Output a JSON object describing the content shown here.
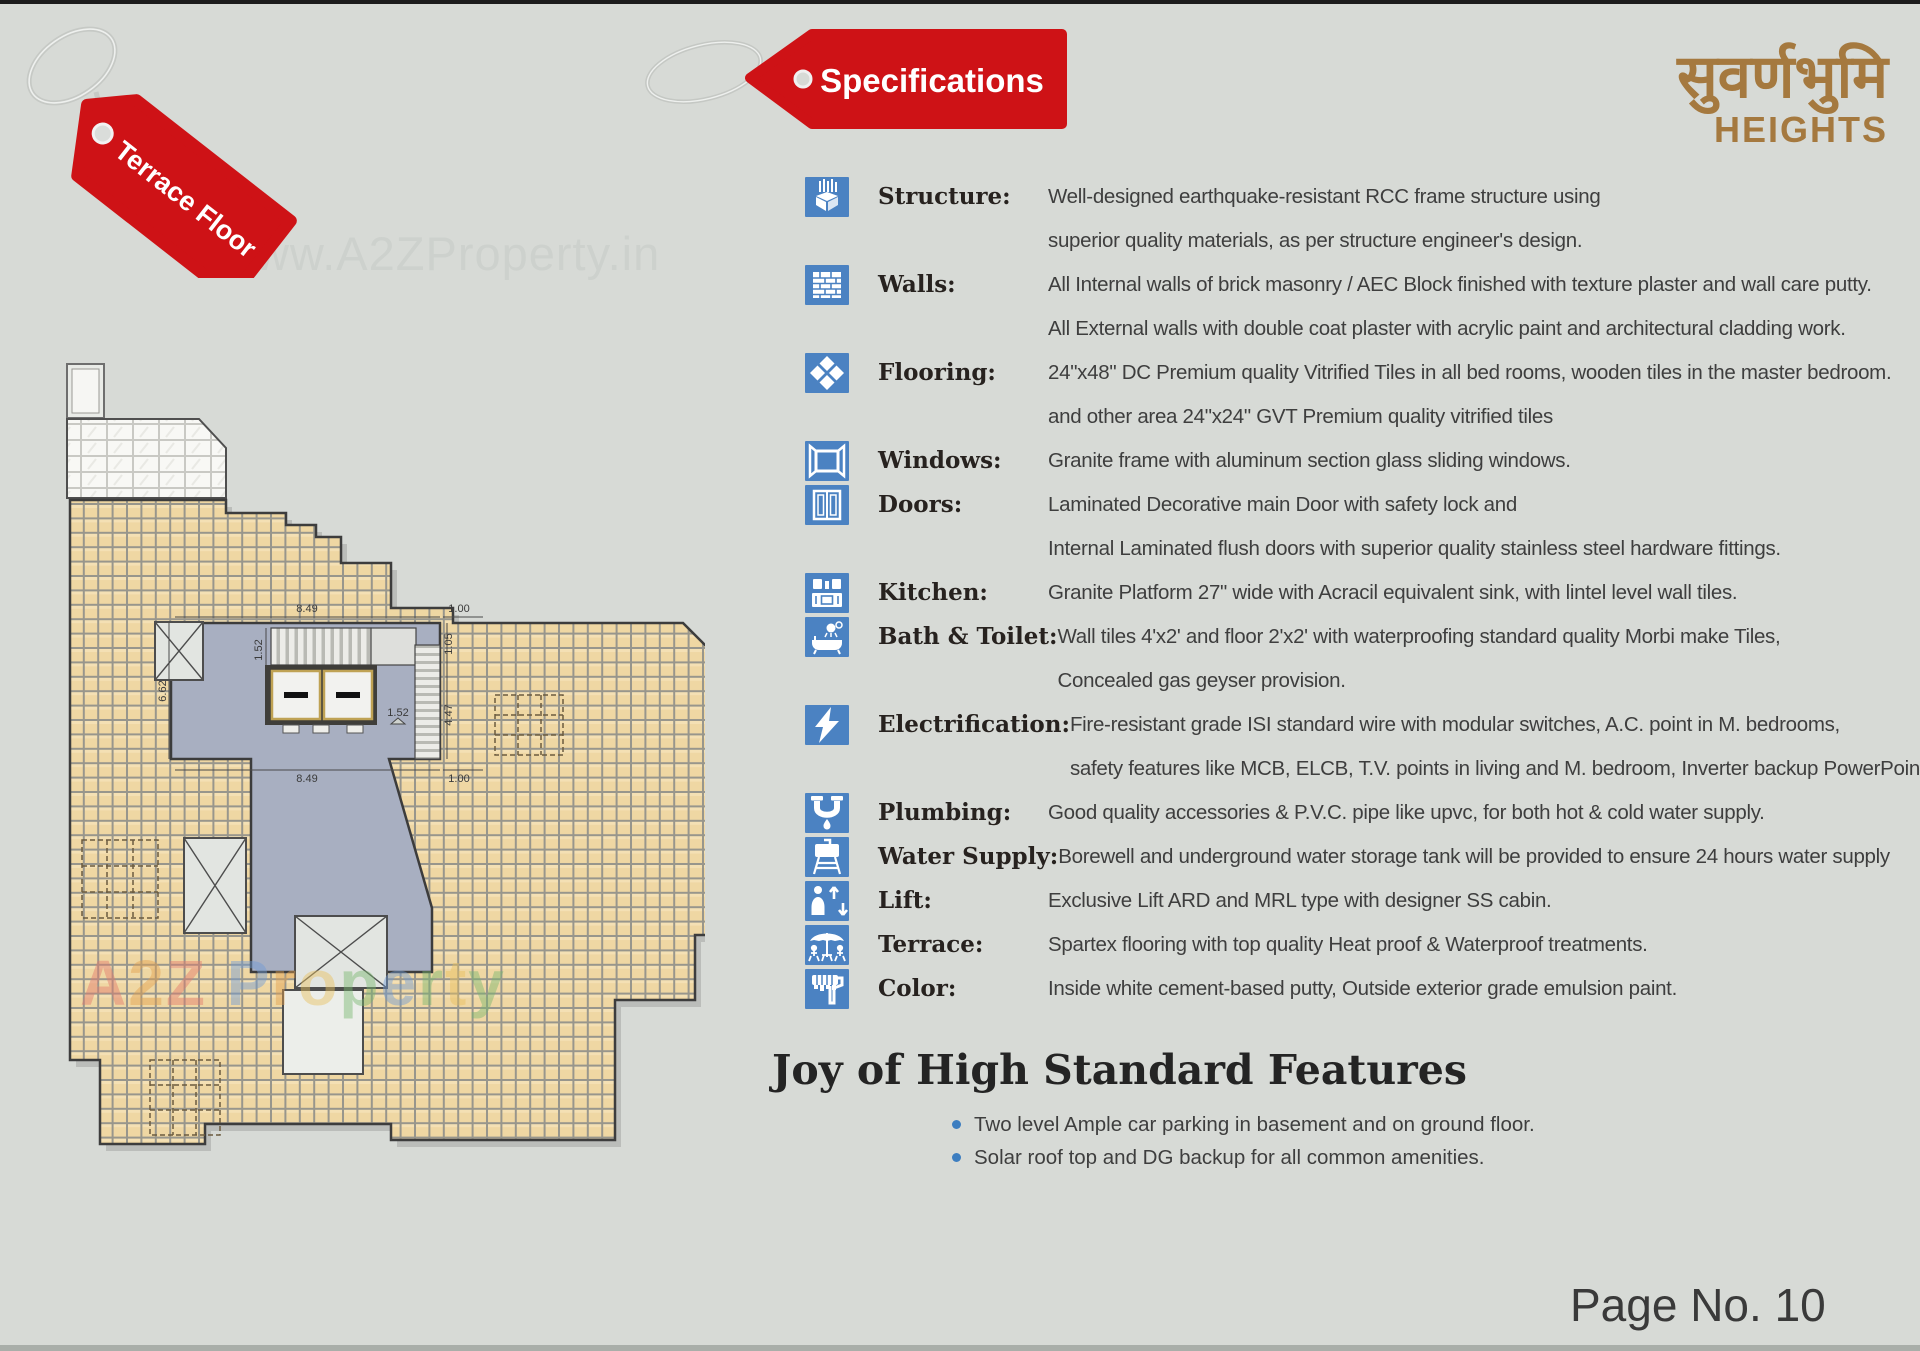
{
  "page": {
    "background": "#d7dad6",
    "page_no": "Page No. 10"
  },
  "tags": {
    "floor_tag": "Terrace Floor",
    "spec_tag": "Specifications",
    "tag_color": "#ce1216"
  },
  "brand": {
    "name_devanagari": "सुवर्णभुमि",
    "name_sub": "HEIGHTS",
    "color": "#a5793f"
  },
  "watermarks": {
    "top": "www.A2ZProperty.in",
    "middle": "A2Z Property",
    "middle_colors": [
      "#e27a6c",
      "#e2a04e",
      "#e27a6c",
      "#000000",
      "#6f9bd6",
      "#e2a04e",
      "#e9c05e",
      "#79b76f",
      "#6f9bd6",
      "#79b76f",
      "#e9c05e",
      "#79b76f"
    ]
  },
  "specs": {
    "icon_color": "#4b82c2",
    "rows": [
      {
        "icon": "structure-icon",
        "label": "Structure:",
        "lines": [
          "Well-designed earthquake-resistant RCC frame structure using",
          "superior quality materials, as per structure engineer's design."
        ]
      },
      {
        "icon": "walls-icon",
        "label": "Walls:",
        "lines": [
          "All Internal walls of brick masonry / AEC Block finished with texture plaster and wall care putty.",
          "All External walls with double coat plaster with acrylic paint and architectural cladding work."
        ]
      },
      {
        "icon": "flooring-icon",
        "label": "Flooring:",
        "lines": [
          "24\"x48\" DC Premium quality Vitrified Tiles in all bed rooms, wooden tiles in the master bedroom.",
          "and other area 24\"x24\" GVT Premium quality vitrified tiles"
        ]
      },
      {
        "icon": "windows-icon",
        "label": "Windows:",
        "lines": [
          "Granite frame with aluminum section glass sliding windows."
        ]
      },
      {
        "icon": "doors-icon",
        "label": "Doors:",
        "lines": [
          "Laminated Decorative main Door with safety lock and",
          "Internal Laminated flush doors with superior quality stainless steel hardware fittings."
        ]
      },
      {
        "icon": "kitchen-icon",
        "label": "Kitchen:",
        "lines": [
          "Granite Platform 27\" wide with Acracil equivalent sink, with lintel level wall tiles."
        ]
      },
      {
        "icon": "bath-toilet-icon",
        "label": "Bath & Toilet:",
        "lines": [
          "Wall tiles 4'x2' and floor 2'x2' with waterproofing standard quality Morbi make Tiles,",
          "Concealed gas geyser provision."
        ]
      },
      {
        "icon": "electrification-icon",
        "label": "Electrification:",
        "lines": [
          "Fire-resistant grade ISI standard wire with modular switches, A.C. point in M. bedrooms,",
          "safety features like MCB,  ELCB, T.V. points in living and M. bedroom, Inverter backup PowerPoint."
        ]
      },
      {
        "icon": "plumbing-icon",
        "label": "Plumbing:",
        "lines": [
          "Good quality accessories & P.V.C. pipe like upvc, for both hot & cold water supply."
        ]
      },
      {
        "icon": "water-supply-icon",
        "label": "Water Supply:",
        "lines": [
          "Borewell and underground water storage tank will be provided to ensure 24 hours water supply"
        ]
      },
      {
        "icon": "lift-icon",
        "label": "Lift:",
        "lines": [
          "Exclusive Lift ARD and MRL type with designer SS cabin."
        ]
      },
      {
        "icon": "terrace-icon",
        "label": "Terrace:",
        "lines": [
          "Spartex flooring with top quality Heat proof & Waterproof treatments."
        ]
      },
      {
        "icon": "color-icon",
        "label": "Color:",
        "lines": [
          "Inside white cement-based putty, Outside exterior grade emulsion paint."
        ]
      }
    ]
  },
  "features": {
    "title": "Joy of High Standard Features",
    "bullet_color": "#3d7ec0",
    "items": [
      "Two level Ample car parking in basement and on ground floor.",
      "Solar roof top and DG backup for all common amenities."
    ]
  },
  "floor_plan": {
    "tile_color": "#efd7a3",
    "core_color": "#a8afc1",
    "dims": [
      {
        "text": "8.49"
      },
      {
        "text": "1.00"
      },
      {
        "text": "1.52"
      },
      {
        "text": "1.05"
      },
      {
        "text": "6.62"
      },
      {
        "text": "4.47"
      },
      {
        "text": "1.52"
      },
      {
        "text": "8.49"
      },
      {
        "text": "1.00"
      }
    ]
  }
}
